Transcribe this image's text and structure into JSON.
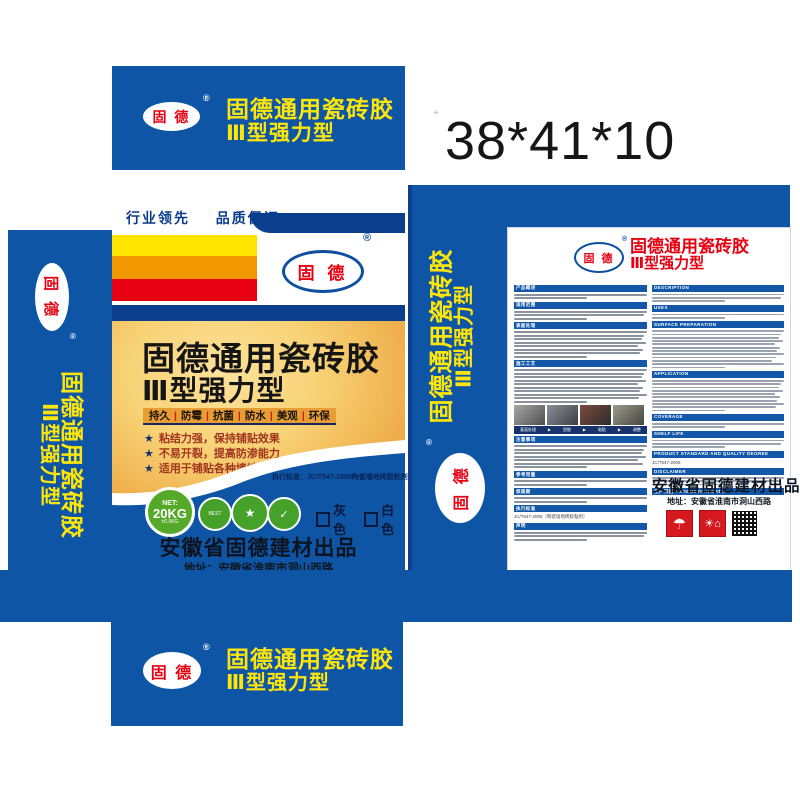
{
  "sheet": {
    "size_label": "38*41*10"
  },
  "brand": {
    "logo_text": "固 德",
    "registered": "®",
    "title_line1": "固德通用瓷砖胶",
    "title_line2": "Ⅲ型强力型"
  },
  "colors": {
    "main_blue": "#0e55a6",
    "navy_accent": "#0c3e8e",
    "brand_yellow": "#ffe60a",
    "brand_red": "#e60012",
    "gold_light": "#f8d276",
    "gold_deep": "#e89a33",
    "net_green": "#55a928"
  },
  "front": {
    "slogan_left": "行业领先",
    "slogan_right": "品质保证",
    "features_bar": [
      "持久",
      "防霉",
      "抗菌",
      "防水",
      "美观",
      "环保"
    ],
    "features_list": [
      "粘结力强，保持铺贴效果",
      "不易开裂，提高防渗能力",
      "适用于铺贴各种墙地砖"
    ],
    "standard_line": "执行标准：JC/T547-2005陶瓷墙地砖胶粘剂",
    "net": {
      "label": "NET:",
      "weight": "20KG",
      "tolerance": "±0.5KG"
    },
    "badges": [
      {
        "name": "best-seal-badge",
        "glyph": "BEST"
      },
      {
        "name": "trust-ribbon-badge",
        "glyph": "★"
      },
      {
        "name": "certified-product-badge",
        "glyph": "✓"
      }
    ],
    "color_options": [
      "灰色",
      "白色"
    ],
    "producer": "安徽省固德建材出品",
    "address": "地址：安徽省淮南市洞山西路"
  },
  "back": {
    "sections_cn": [
      {
        "title": "产品概述",
        "lines": 2
      },
      {
        "title": "适用范围",
        "lines": 3
      },
      {
        "title": "表面处理",
        "lines": 8
      },
      {
        "title": "施工工艺",
        "lines": 10,
        "photos": true
      },
      {
        "title": "注意事项",
        "lines": 7
      },
      {
        "title": "参考用量",
        "lines": 2
      },
      {
        "title": "保质期",
        "lines": 2
      },
      {
        "title": "执行标准",
        "lines": 0,
        "body": "JC/T547-2005（陶瓷墙地砖胶粘剂）"
      },
      {
        "title": "声明",
        "lines": 3
      }
    ],
    "sections_en": [
      {
        "title": "DESCRIPTION",
        "lines": 3
      },
      {
        "title": "USES",
        "lines": 2
      },
      {
        "title": "SURFACE PREPARATION",
        "lines": 12
      },
      {
        "title": "APPLICATION",
        "lines": 10
      },
      {
        "title": "COVERAGE",
        "lines": 2
      },
      {
        "title": "SHELF LIFE",
        "lines": 3
      },
      {
        "title": "PRODUCT STANDARD AND QUALITY DEGREE",
        "lines": 0,
        "body": "JC/T547-2005"
      },
      {
        "title": "DISCLAIMER",
        "lines": 3
      },
      {
        "title": "生产日期 PRODUCTION DATE",
        "lines": 0
      }
    ],
    "process_steps": [
      "基面处理",
      "刮胶",
      "粘贴",
      "调整"
    ],
    "producer": "安徽省固德建材出品",
    "address": "地址：安徽省淮南市洞山西路",
    "icons": [
      "keep-dry-icon",
      "keep-away-from-sun-icon",
      "qr-code"
    ]
  }
}
